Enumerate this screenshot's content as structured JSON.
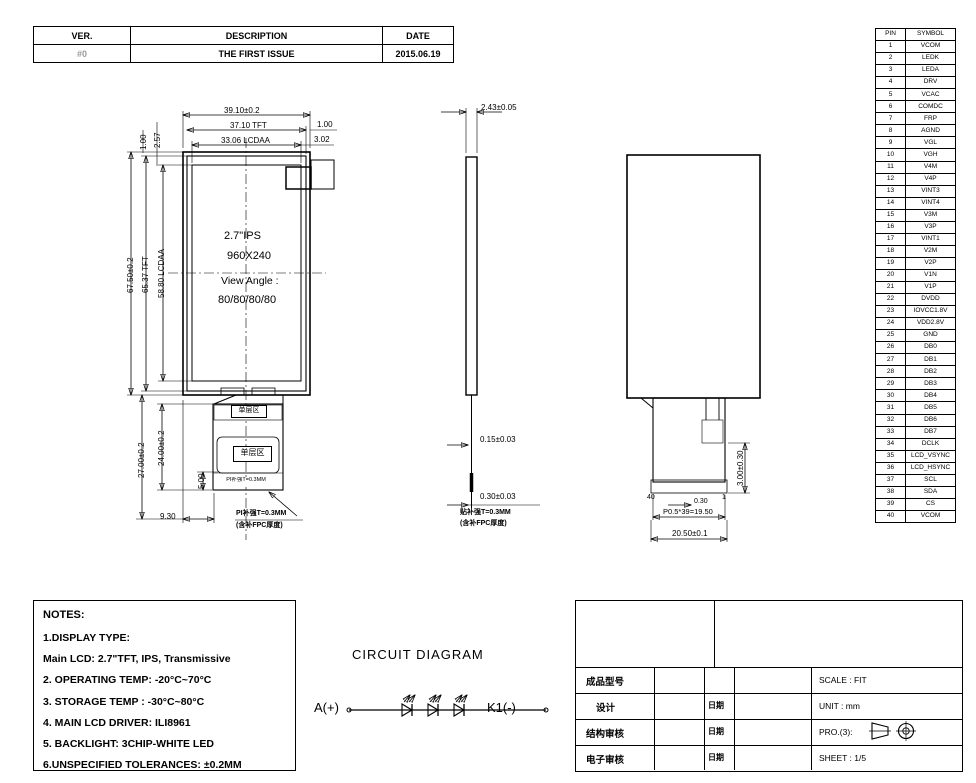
{
  "colors": {
    "line": "#000000",
    "background": "#ffffff",
    "ver_text": "#9a9a9a"
  },
  "revision_table": {
    "headers": {
      "ver": "VER.",
      "description": "DESCRIPTION",
      "date": "DATE"
    },
    "row": {
      "ver": "#0",
      "description": "THE FIRST ISSUE",
      "date": "2015.06.19"
    }
  },
  "pin_table": {
    "headers": {
      "pin": "PIN",
      "symbol": "SYMBOL"
    },
    "pins": [
      "VCOM",
      "LEDK",
      "LEDA",
      "DRV",
      "VCAC",
      "COMDC",
      "FRP",
      "AGND",
      "VGL",
      "VGH",
      "V4M",
      "V4P",
      "VINT3",
      "VINT4",
      "V3M",
      "V3P",
      "VINT1",
      "V2M",
      "V2P",
      "V1N",
      "V1P",
      "DVDD",
      "IOVCC1.8V",
      "VDD2.8V",
      "GND",
      "DB0",
      "DB1",
      "DB2",
      "DB3",
      "DB4",
      "DB5",
      "DB6",
      "DB7",
      "DCLK",
      "LCD_VSYNC",
      "LCD_HSYNC",
      "SCL",
      "SDA",
      "CS",
      "VCOM"
    ]
  },
  "front_view": {
    "dim_width_total": "39.10±0.2",
    "dim_width_tft": "37.10 TFT",
    "dim_width_lcdaa": "33.06 LCDAA",
    "dim_right_margin": "1.00",
    "dim_right_margin2": "3.02",
    "dim_left_margin": "1.00",
    "dim_left_margin2": "2.57",
    "dim_height_total": "67.50±0.2",
    "dim_height_tft": "65.37 TFT",
    "dim_height_lcdaa": "58.80 LCDAA",
    "panel_type": "2.7\"IPS",
    "resolution": "960X240",
    "view_angle_label": "View Angle :",
    "view_angle_value": "80/80/80/80",
    "single_layer_label": "单层区",
    "single_layer_label2": "单层区",
    "stiffener_strip_label": "PI补强T=0.3MM",
    "dim_fpc_total": "27.00±0.2",
    "dim_fpc_body": "24.00±0.2",
    "dim_stiffener_h": "5.00",
    "dim_fpc_offset": "9.30",
    "callout_line1": "PI补强T=0.3MM",
    "callout_line2": "(含补FPC厚度)"
  },
  "side_view": {
    "dim_thickness": "2.43±0.05",
    "dim_fpc_thickness": "0.15±0.03",
    "dim_stiffener_thickness": "0.30±0.03",
    "note_line1": "贴补强T=0.3MM",
    "note_line2": "(含补FPC厚度)"
  },
  "back_view": {
    "dim_connector_h": "3.00±0.30",
    "pin_first": "40",
    "pin_last": "1",
    "dim_pitch": "0.30",
    "dim_pitch_total": "P0.5*39=19.50",
    "dim_connector_w": "20.50±0.1"
  },
  "notes": {
    "title": "NOTES:",
    "lines": [
      "1.DISPLAY TYPE:",
      "Main LCD: 2.7\"TFT, IPS, Transmissive",
      "2. OPERATING TEMP: -20°C~70°C",
      "3. STORAGE TEMP : -30°C~80°C",
      "4. MAIN LCD DRIVER: ILI8961",
      "5. BACKLIGHT: 3CHIP-WHITE LED",
      "6.UNSPECIFIED TOLERANCES: ±0.2MM"
    ]
  },
  "circuit": {
    "title": "CIRCUIT DIAGRAM",
    "anode_label": "A(+)",
    "cathode_label": "K1(-)"
  },
  "title_block": {
    "product_model_label": "成品型号",
    "design_label": "设计",
    "structure_review_label": "结构审核",
    "electronic_review_label": "电子审核",
    "date_label": "日期",
    "scale": "SCALE : FIT",
    "unit": "UNIT : mm",
    "projection": "PRO.(3):",
    "sheet": "SHEET : 1/5"
  }
}
